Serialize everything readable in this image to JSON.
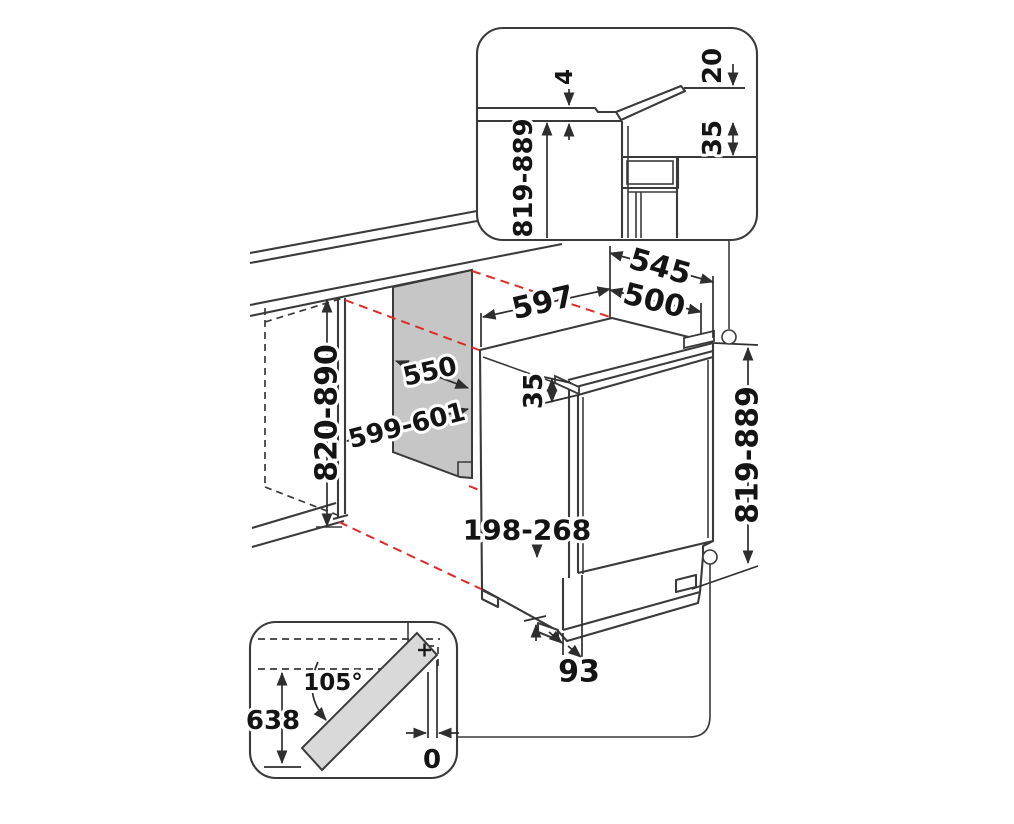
{
  "figure": {
    "kind": "built-under-appliance-installation-diagram",
    "background": "#ffffff"
  },
  "colors": {
    "line": "#3a3a3a",
    "dimension_text": "#141414",
    "red_projection": "#e02a25",
    "niche_panel_gray": "#c6c6c6",
    "door_gray": "#d9d9d9"
  },
  "dimensions_main": {
    "top_width": "597",
    "depth_total": "545",
    "depth_body": "500",
    "niche_depth": "550",
    "niche_width": "599-601",
    "niche_height": "820-890",
    "unit_height": "819-889",
    "door_top_gap": "35",
    "plinth_height_range": "198-268",
    "plinth_recess": "93"
  },
  "inset_top_detail": {
    "height_range": "819-889",
    "worktop_gap": "4",
    "flap_tilt": "20",
    "top_clearance": "35"
  },
  "inset_door_swing": {
    "opening_angle": "105°",
    "swing_depth": "638",
    "zero_clearance": "0",
    "plus_sign": "+"
  }
}
